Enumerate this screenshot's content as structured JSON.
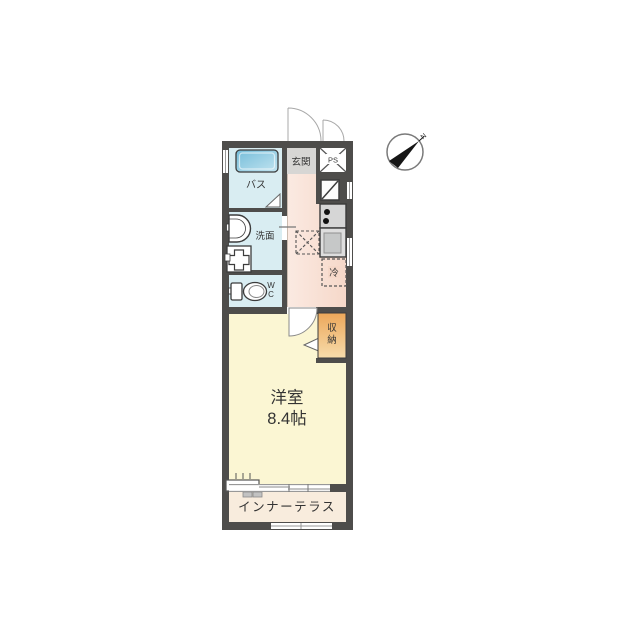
{
  "compass": {
    "north": "N"
  },
  "labels": {
    "bath": "バス",
    "entrance": "玄関",
    "pipe_space": "PS",
    "washroom": "洗面",
    "wc_l1": "W",
    "wc_l2": "C",
    "fridge": "冷",
    "storage_l1": "収",
    "storage_l2": "納",
    "room_l1": "洋室",
    "room_l2": "8.4帖",
    "terrace": "インナーテラス"
  },
  "colors": {
    "wall": "#4e4d4b",
    "wet_room": "#d9edf2",
    "tub_dark": "#74bcd9",
    "tub_light": "#c2e4f0",
    "entrance_floor": "#d7d6d4",
    "kitchen_light": "#fbeae2",
    "kitchen_dark": "#f6d8c9",
    "storage_top": "#eca75a",
    "storage_bottom": "#f7dcab",
    "main_room": "#fbf6d3",
    "terrace_floor": "#f8ecdd",
    "outline": "#3c3c3c"
  }
}
